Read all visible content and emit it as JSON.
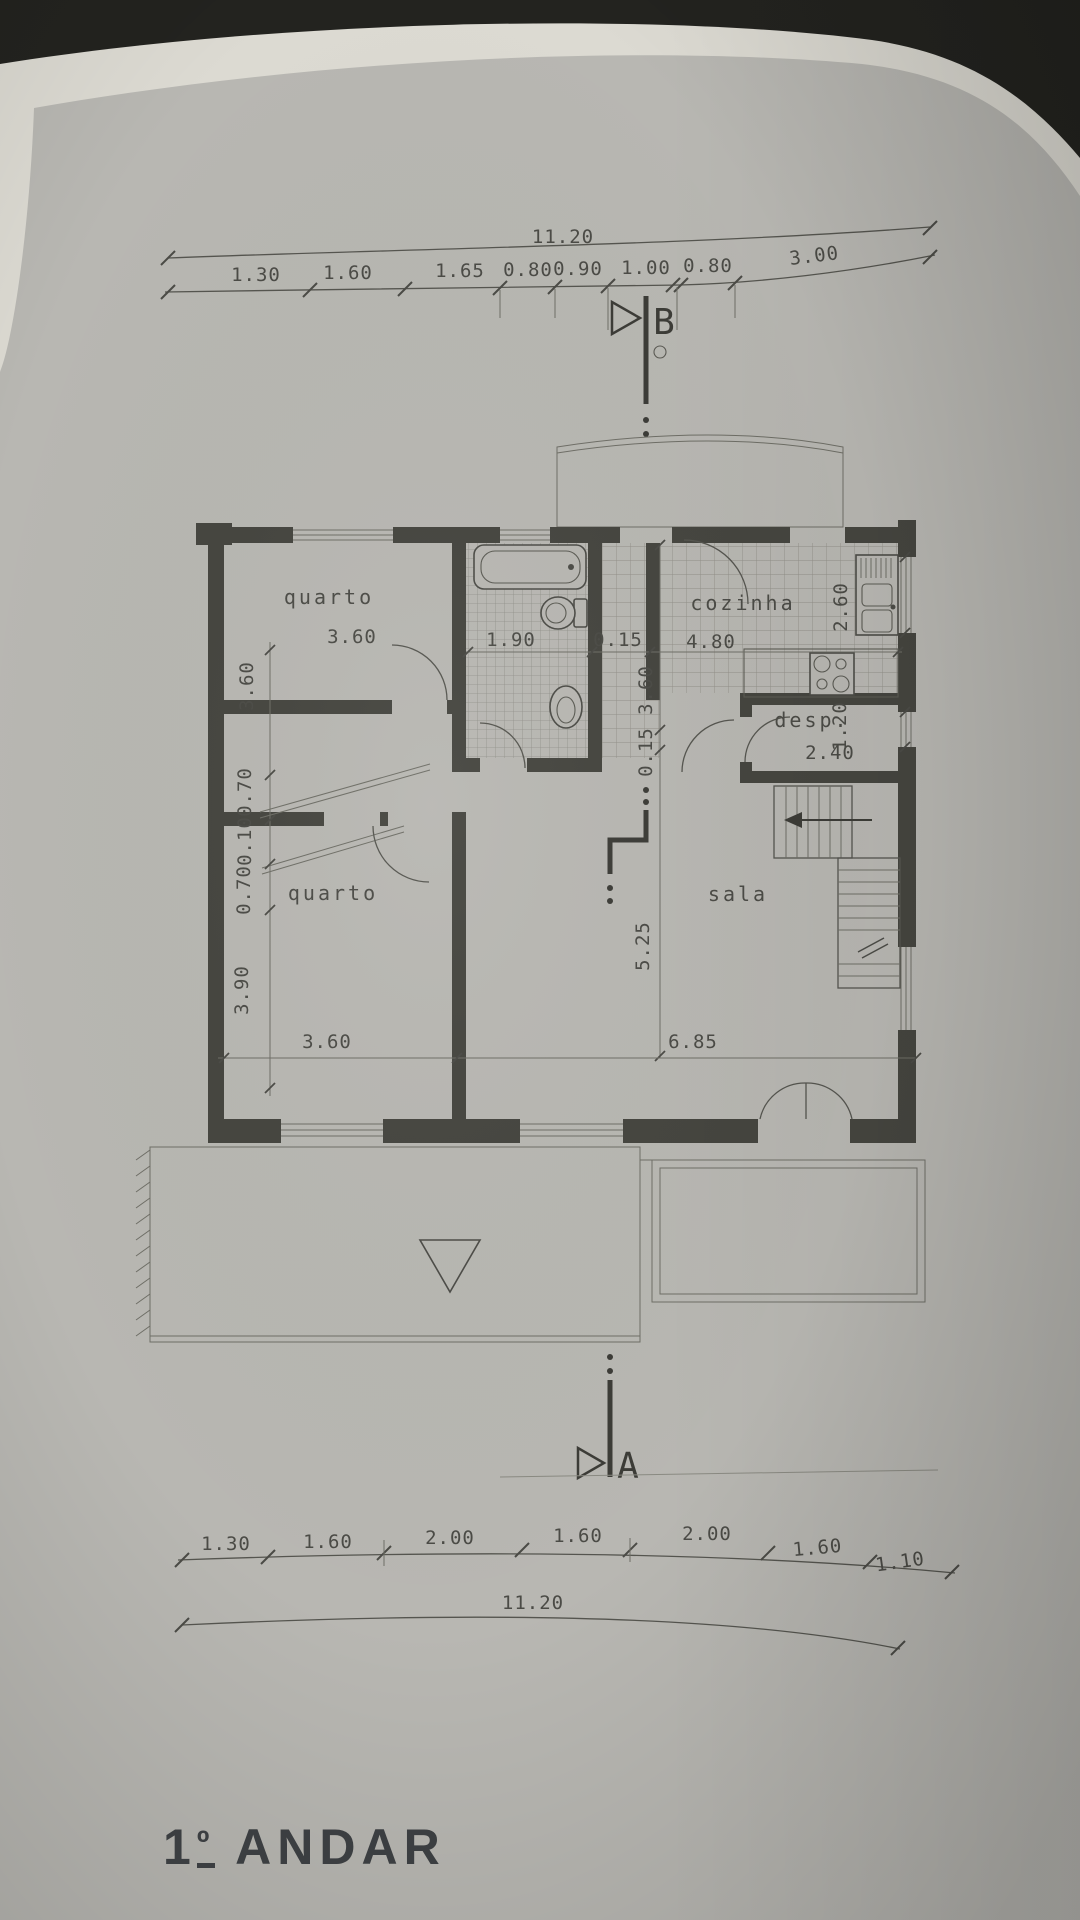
{
  "floor_label": {
    "number": "1",
    "ordinal_symbol": "º",
    "text": "ANDAR"
  },
  "section_markers": {
    "top": "B",
    "bottom": "A"
  },
  "dim_chains": {
    "top": {
      "total": "11.20",
      "segments": [
        "1.30",
        "1.60",
        "1.65",
        "0.80",
        "0.90",
        "1.00",
        "0.80",
        "3.00"
      ]
    },
    "bottom": {
      "total": "11.20",
      "segments": [
        "1.30",
        "1.60",
        "2.00",
        "1.60",
        "2.00",
        "1.60",
        "1.10"
      ]
    },
    "left": {
      "segments": [
        "3.60",
        "0.70",
        "0.10",
        "0.70",
        "3.90"
      ]
    }
  },
  "rooms": {
    "quarto_top": {
      "label": "quarto",
      "width": "3.60"
    },
    "quarto_bottom": {
      "label": "quarto",
      "width": "3.60"
    },
    "bathroom": {
      "width": "1.90"
    },
    "cozinha": {
      "label": "cozinha",
      "width": "4.80",
      "depth": "2.60"
    },
    "despensa": {
      "label": "desp.",
      "width": "2.40",
      "depth": "1.20"
    },
    "sala": {
      "label": "sala",
      "width": "6.85",
      "depth": "5.25"
    }
  },
  "wall_dims": {
    "partition_top": "0.15",
    "kitchen_depth": "3.60",
    "partition_mid": "0.15"
  }
}
